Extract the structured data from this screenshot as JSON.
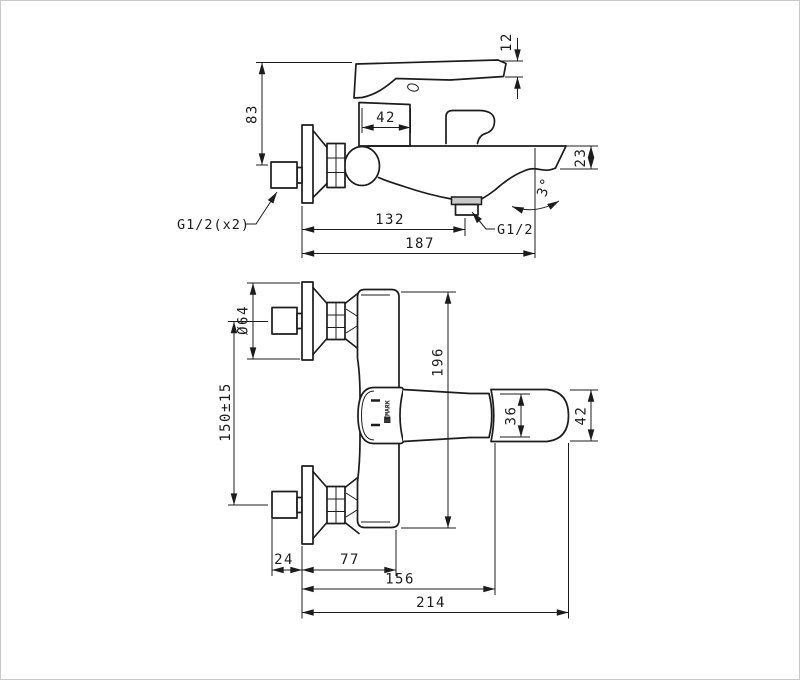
{
  "meta": {
    "type": "technical-drawing",
    "subject": "Wall-mounted bath mixer faucet - dimensional drawing, two views",
    "brand": "LEMARK"
  },
  "colors": {
    "ink": "#1c1c1c",
    "background": "#ffffff",
    "frame": "#c9c9c9",
    "metal": "#c9c9c9"
  },
  "side_view": {
    "dim_lever_tip": "12",
    "dim_height": "83",
    "dim_cartridge": "42",
    "dim_spout_drop": "23",
    "dim_to_shower_outlet": "132",
    "dim_total_reach": "187",
    "angle_spout": "3°",
    "label_wall_thread": "G1/2(x2)",
    "label_shower_thread": "G1/2"
  },
  "front_view": {
    "dim_flange_dia": "Ø64",
    "dim_mount_spacing": "150±15",
    "dim_body_length": "196",
    "dim_handle_width": "36",
    "dim_handle_tip": "42",
    "dim_eccentric": "24",
    "dim_wall_to_body": "77",
    "dim_wall_to_grip": "156",
    "dim_wall_to_tip": "214",
    "logo": "LEMARK"
  }
}
